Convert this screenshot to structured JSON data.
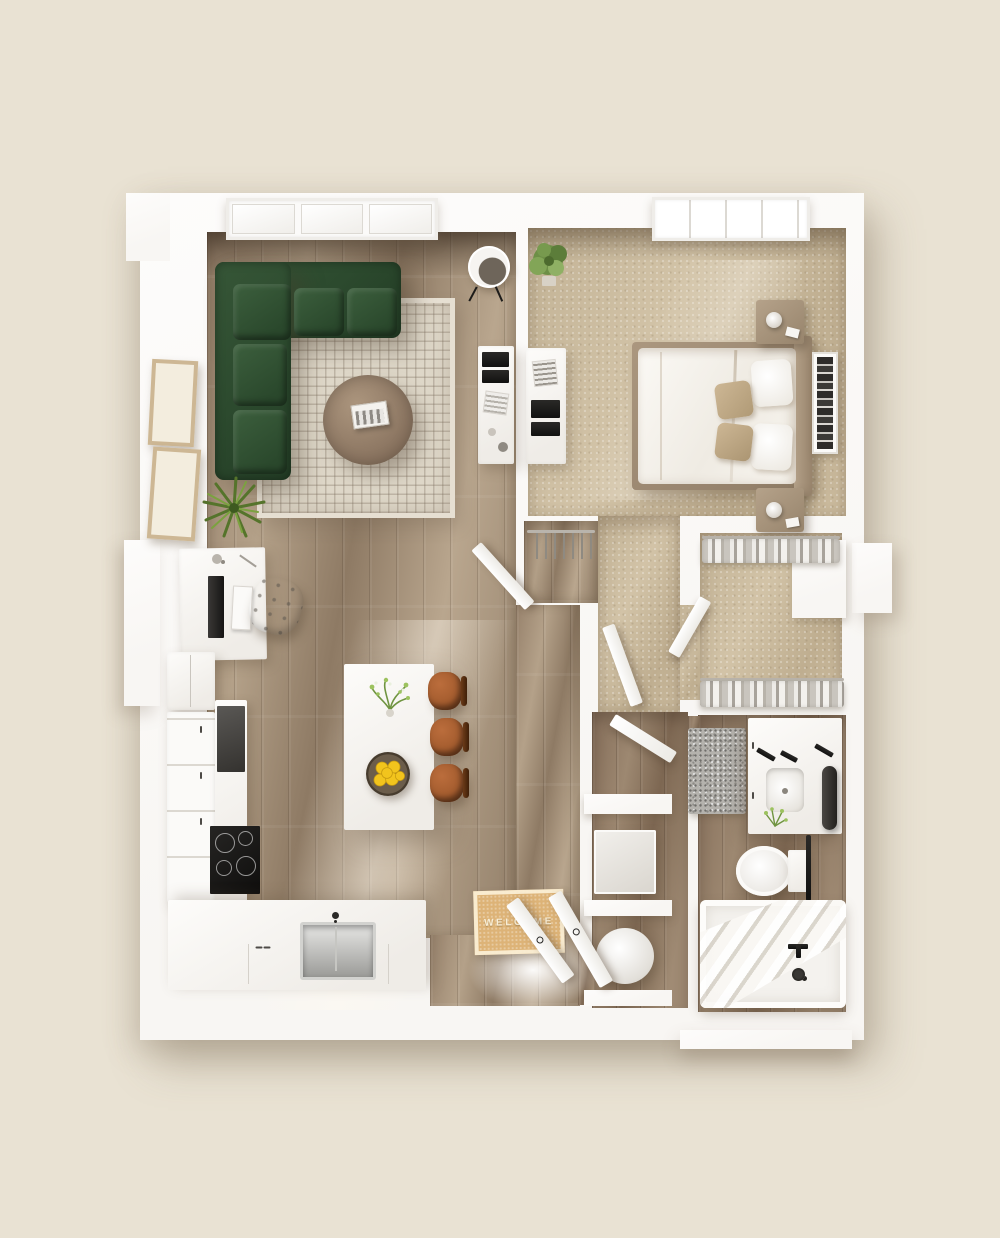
{
  "scene": {
    "type": "3d-floor-plan-render",
    "view": "top-down",
    "rooms": [
      {
        "id": "living-room",
        "floor": "wood-plank"
      },
      {
        "id": "dining-kitchen",
        "floor": "wood-plank"
      },
      {
        "id": "bedroom",
        "floor": "carpet"
      },
      {
        "id": "bedroom-hallway",
        "floor": "carpet"
      },
      {
        "id": "walk-in-closet",
        "floor": "carpet"
      },
      {
        "id": "coat-closet",
        "floor": "wood-plank"
      },
      {
        "id": "bathroom",
        "floor": "wood-tile"
      },
      {
        "id": "bathroom-hallway",
        "floor": "wood-tile"
      },
      {
        "id": "laundry-closet",
        "floor": "wood-tile"
      },
      {
        "id": "entry",
        "floor": "wood-plank"
      }
    ]
  },
  "entry": {
    "mat_text": "WELCOME"
  },
  "palette": {
    "bg": "#e9e2d3",
    "wall": "#f8f6f3",
    "wall-bright": "#fdfcfb",
    "wood": "#a5907a",
    "wood-dark": "#8d7660",
    "carpet": "#c9b99d",
    "carpet-dark": "#bfae90",
    "sofa": "#2c4a2e",
    "sofa-hi": "#3c5f3d",
    "rug": "#ded7c8",
    "table": "#96816b",
    "stool": "#a55d2f",
    "mat": "#ddb377",
    "mat-text": "#f8eed6",
    "lemon": "#f0c11e",
    "plant": "#5f8031",
    "ink": "#23211f"
  }
}
